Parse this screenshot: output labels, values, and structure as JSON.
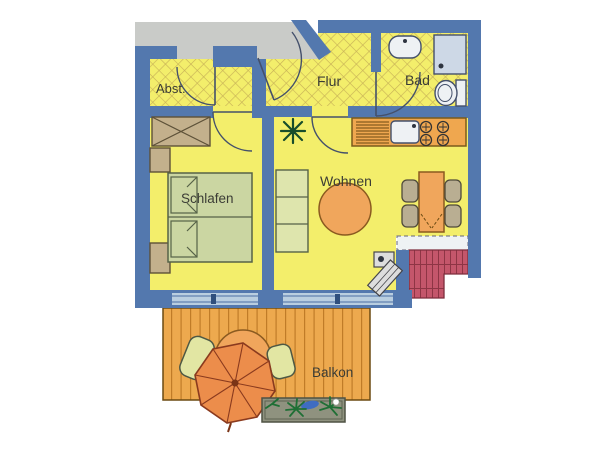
{
  "title": "Apartment floor plan",
  "colors": {
    "wall": "#5378ae",
    "floor": "#f3ee6b",
    "hatch": "#c8b257",
    "landing": "#c9cbc8",
    "counter": "#efa74f",
    "deck": "#eda94e",
    "umbrella": "#ec8d4b",
    "roof": "#c4566b",
    "bed": "#cbd6a2",
    "glass": "#b9cee0",
    "label": "#3b3c35"
  },
  "rooms": {
    "abst": {
      "label": "Abst.",
      "furniture": [
        "door"
      ]
    },
    "flur": {
      "label": "Flur",
      "furniture": [
        "entrance-door"
      ]
    },
    "bad": {
      "label": "Bad",
      "furniture": [
        "washbasin",
        "shower",
        "wc"
      ]
    },
    "schlafen": {
      "label": "Schlafen",
      "furniture": [
        "double-bed",
        "wardrobe",
        "nightstand",
        "nightstand"
      ]
    },
    "wohnen": {
      "label": "Wohnen",
      "furniture": [
        "shelf-sofa",
        "round-table",
        "plant",
        "dining-table",
        "four-chairs",
        "tv-stand",
        "kitchen-counter",
        "kitchen-sink",
        "stove-4-burners"
      ]
    },
    "balkon": {
      "label": "Balkon",
      "furniture": [
        "parasol",
        "table",
        "two-chairs",
        "planter-box"
      ]
    }
  }
}
